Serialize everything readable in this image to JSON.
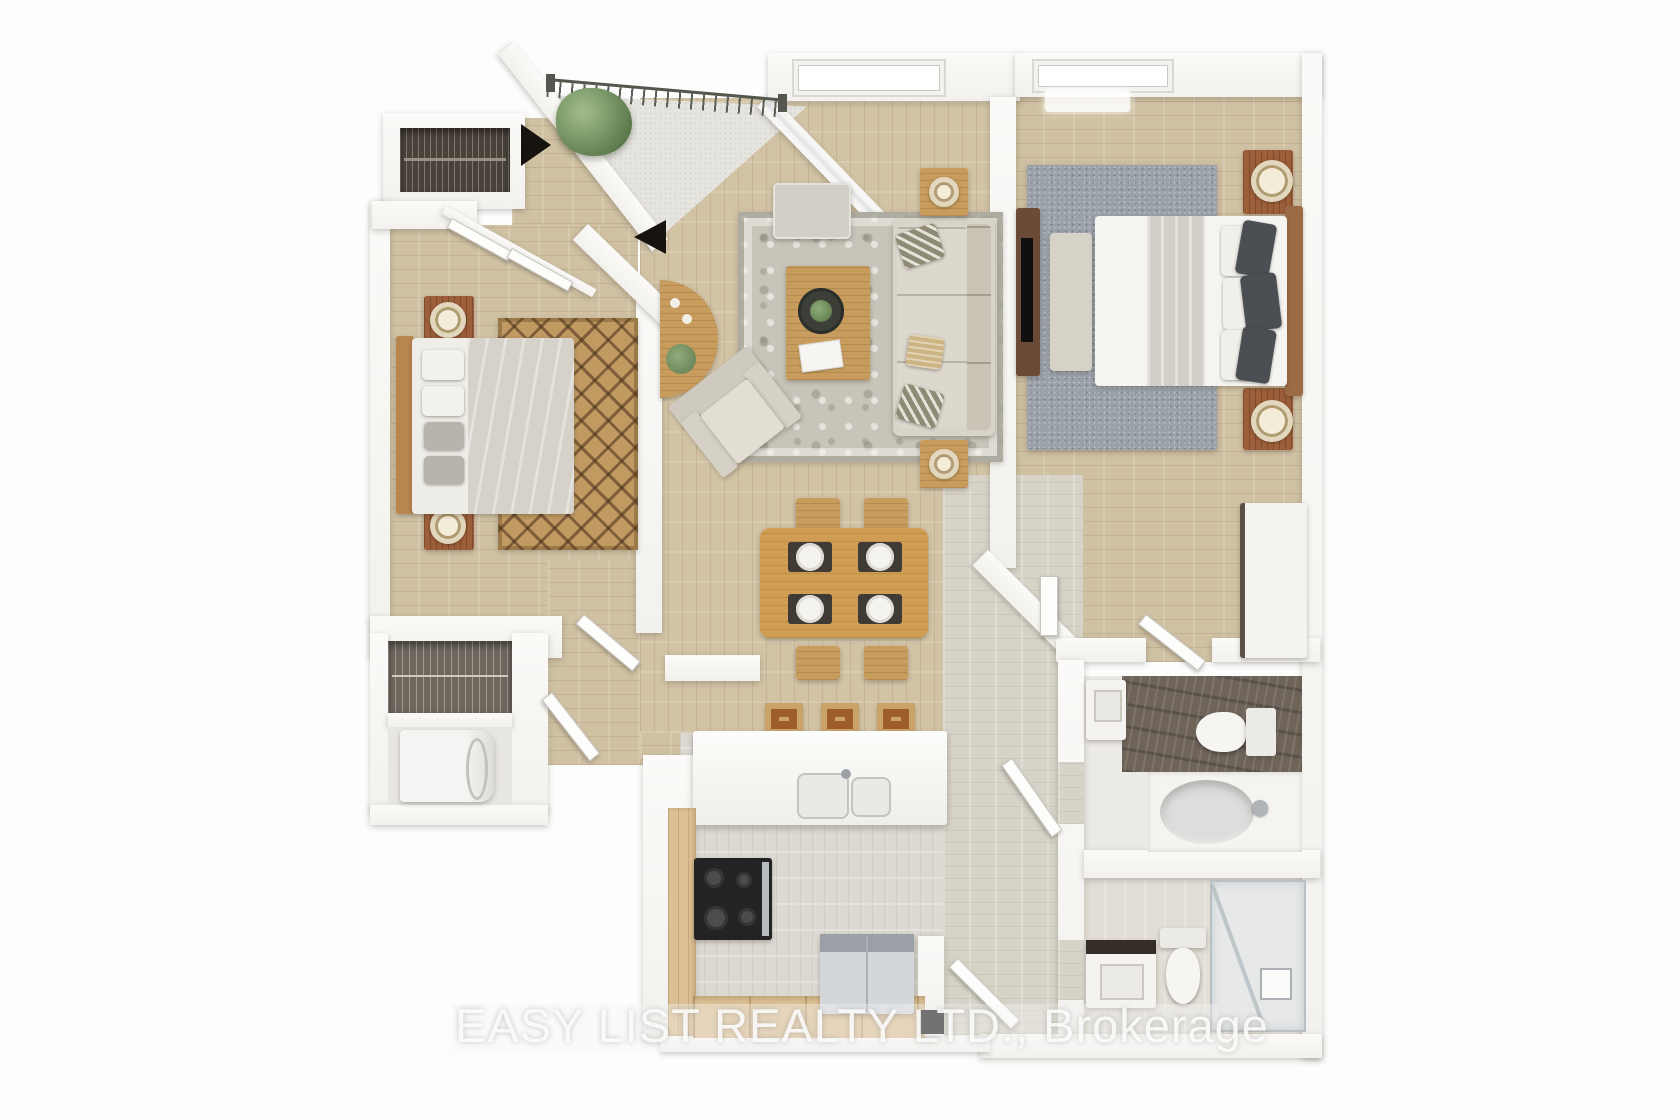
{
  "image_type": "3d-rendered-floor-plan",
  "watermark": {
    "text": "EASY LIST REALTY LTD., Brokerage"
  },
  "palette": {
    "background": "#fdfdfd",
    "wall": "#f7f6f3",
    "floor_warm_wood": "#d2c3a5",
    "floor_pale_wood": "#dcd9d2",
    "balcony_concrete": "#e6e4df",
    "bathroom_marble": "#6e6459",
    "rug_living": "#c7c4b9",
    "rug_bedroom1_jute": "#c19a62",
    "rug_primary_bedroom": "#9aa1a8",
    "sofa_upholstery": "#d9d4ca",
    "wood_oak": "#c89c5d",
    "wood_reddish": "#9c5f3a",
    "appliance_steel": "#d4d7da",
    "plant_green": "#7d9a6b",
    "watermark_color": "rgba(253,253,253,0.88)"
  },
  "scene": {
    "rooms": [
      {
        "id": "entry-foyer",
        "furniture": [
          "entry-closet",
          "front-door-opening"
        ]
      },
      {
        "id": "balcony",
        "furniture": [
          "railing",
          "potted-plant"
        ]
      },
      {
        "id": "bedroom-1",
        "furniture": [
          "bed",
          "headboard",
          "nightstand-x2",
          "lamp-x2",
          "jute-rug",
          "closet-double-doors",
          "door"
        ]
      },
      {
        "id": "living-room",
        "furniture": [
          "sofa",
          "throw-pillows",
          "ottoman",
          "armchair",
          "coffee-table",
          "plant-tray",
          "end-table-x2",
          "candle-x2",
          "console-table",
          "area-rug",
          "window"
        ]
      },
      {
        "id": "dining-area",
        "furniture": [
          "dining-table",
          "chair-x4",
          "placemat-x4",
          "plate-x4"
        ]
      },
      {
        "id": "kitchen",
        "furniture": [
          "island-counter",
          "double-sink",
          "bar-stool-x3",
          "range-cooktop",
          "refrigerator",
          "base-cabinets"
        ]
      },
      {
        "id": "laundry-closet",
        "furniture": [
          "wire-shelf-closet",
          "washer",
          "door"
        ]
      },
      {
        "id": "primary-bedroom",
        "furniture": [
          "bed",
          "headboard",
          "nightstand-x2",
          "lamp-x2",
          "bench",
          "tv-console",
          "tv",
          "rug",
          "wardrobe",
          "window",
          "door"
        ]
      },
      {
        "id": "ensuite-bathroom",
        "furniture": [
          "vanity-sink",
          "toilet",
          "bathtub",
          "faucet",
          "marble-floor",
          "door"
        ]
      },
      {
        "id": "bathroom-2",
        "furniture": [
          "vanity-sink",
          "toilet",
          "glass-shower",
          "shower-fixture",
          "door"
        ]
      },
      {
        "id": "hallway",
        "furniture": [
          "doors"
        ]
      }
    ]
  }
}
